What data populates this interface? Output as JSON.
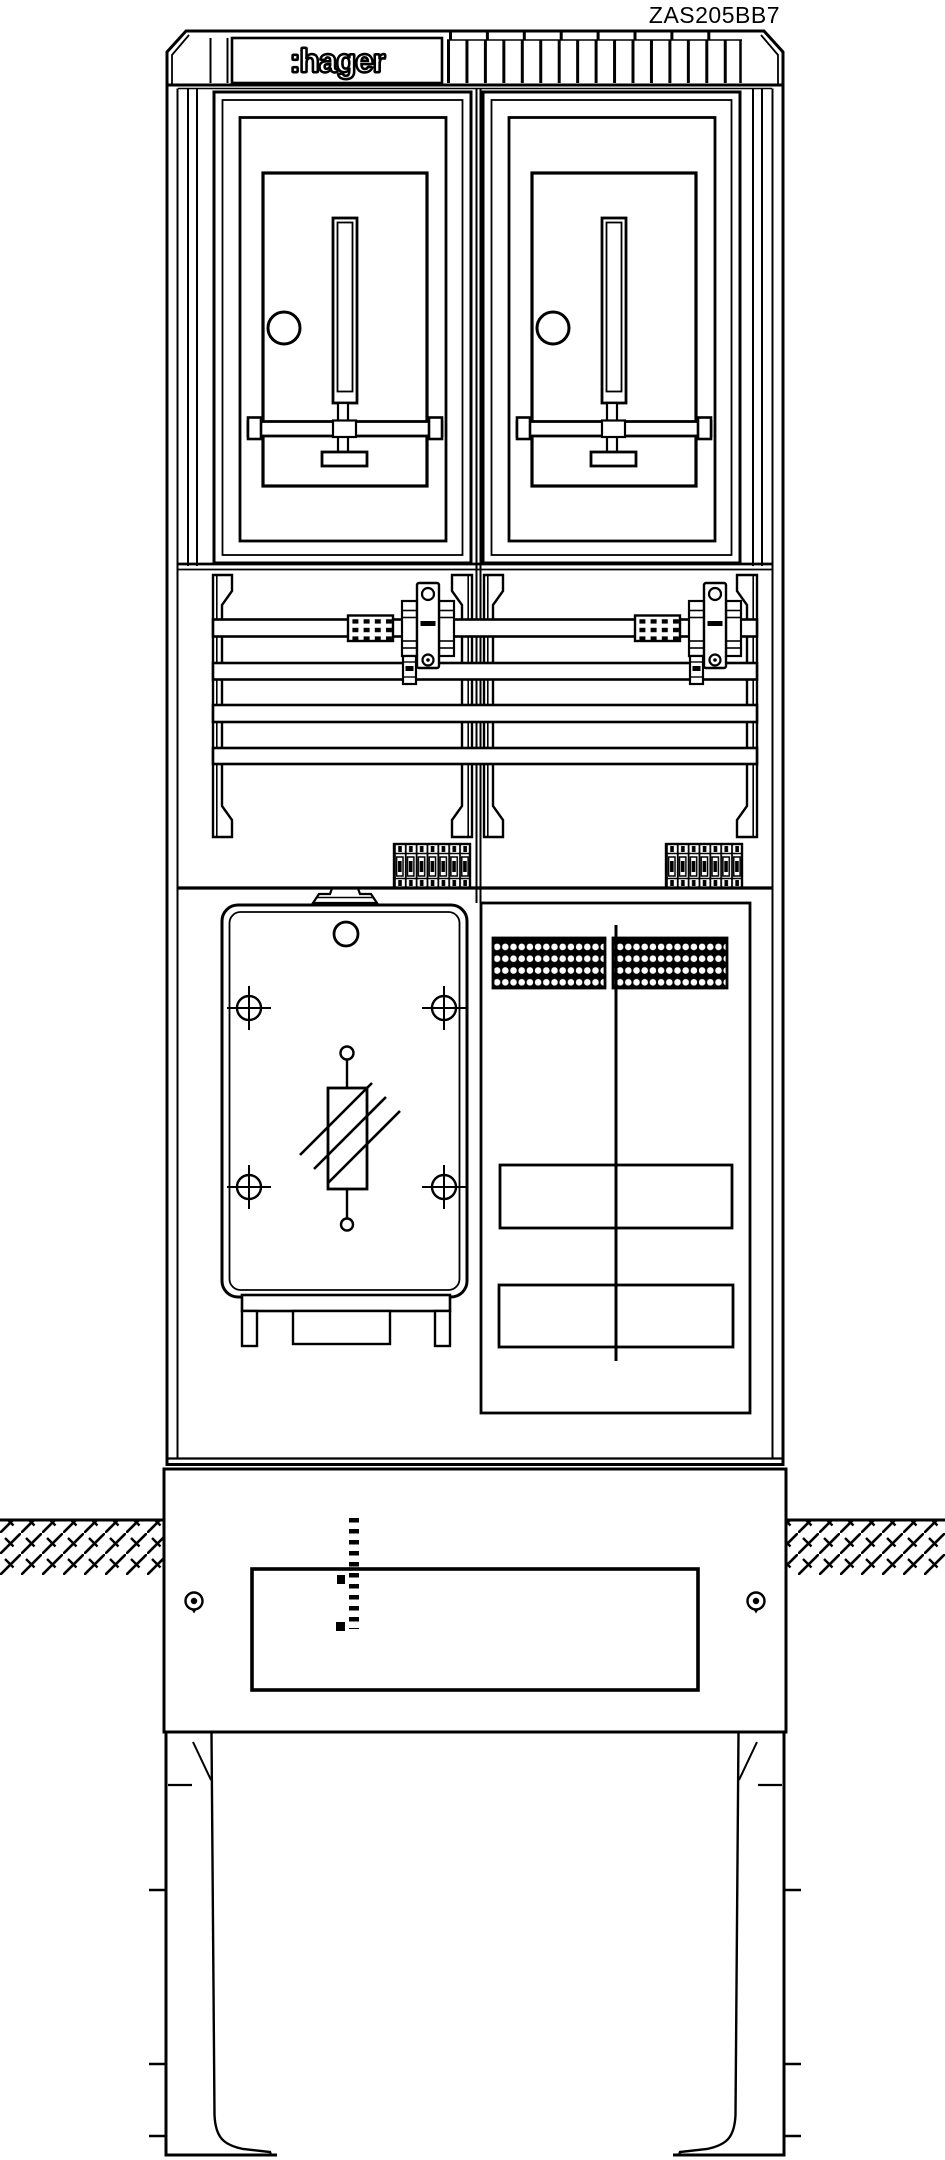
{
  "page": {
    "title": "ZAS205BB7 technical drawing",
    "background_color": "#ffffff",
    "line_color": "#000000"
  },
  "labels": {
    "model": "ZAS205BB7",
    "brand": ":hager"
  },
  "drawing": {
    "type": "meter-pillar-front-view",
    "meter_panel_count": 2,
    "busbar_count": 4,
    "terminal_strip_count": 2,
    "fuse_holder_count": 2,
    "terminal_block_count": 2,
    "mounting_hole_count": 4,
    "screw_count": 2,
    "features": [
      "vent-grille",
      "brand-plate",
      "meter-windows",
      "busbar-compartment",
      "surge-arrester-plate",
      "cable-terminal-panel",
      "ground-level-hatching",
      "buried-base-legs"
    ]
  }
}
